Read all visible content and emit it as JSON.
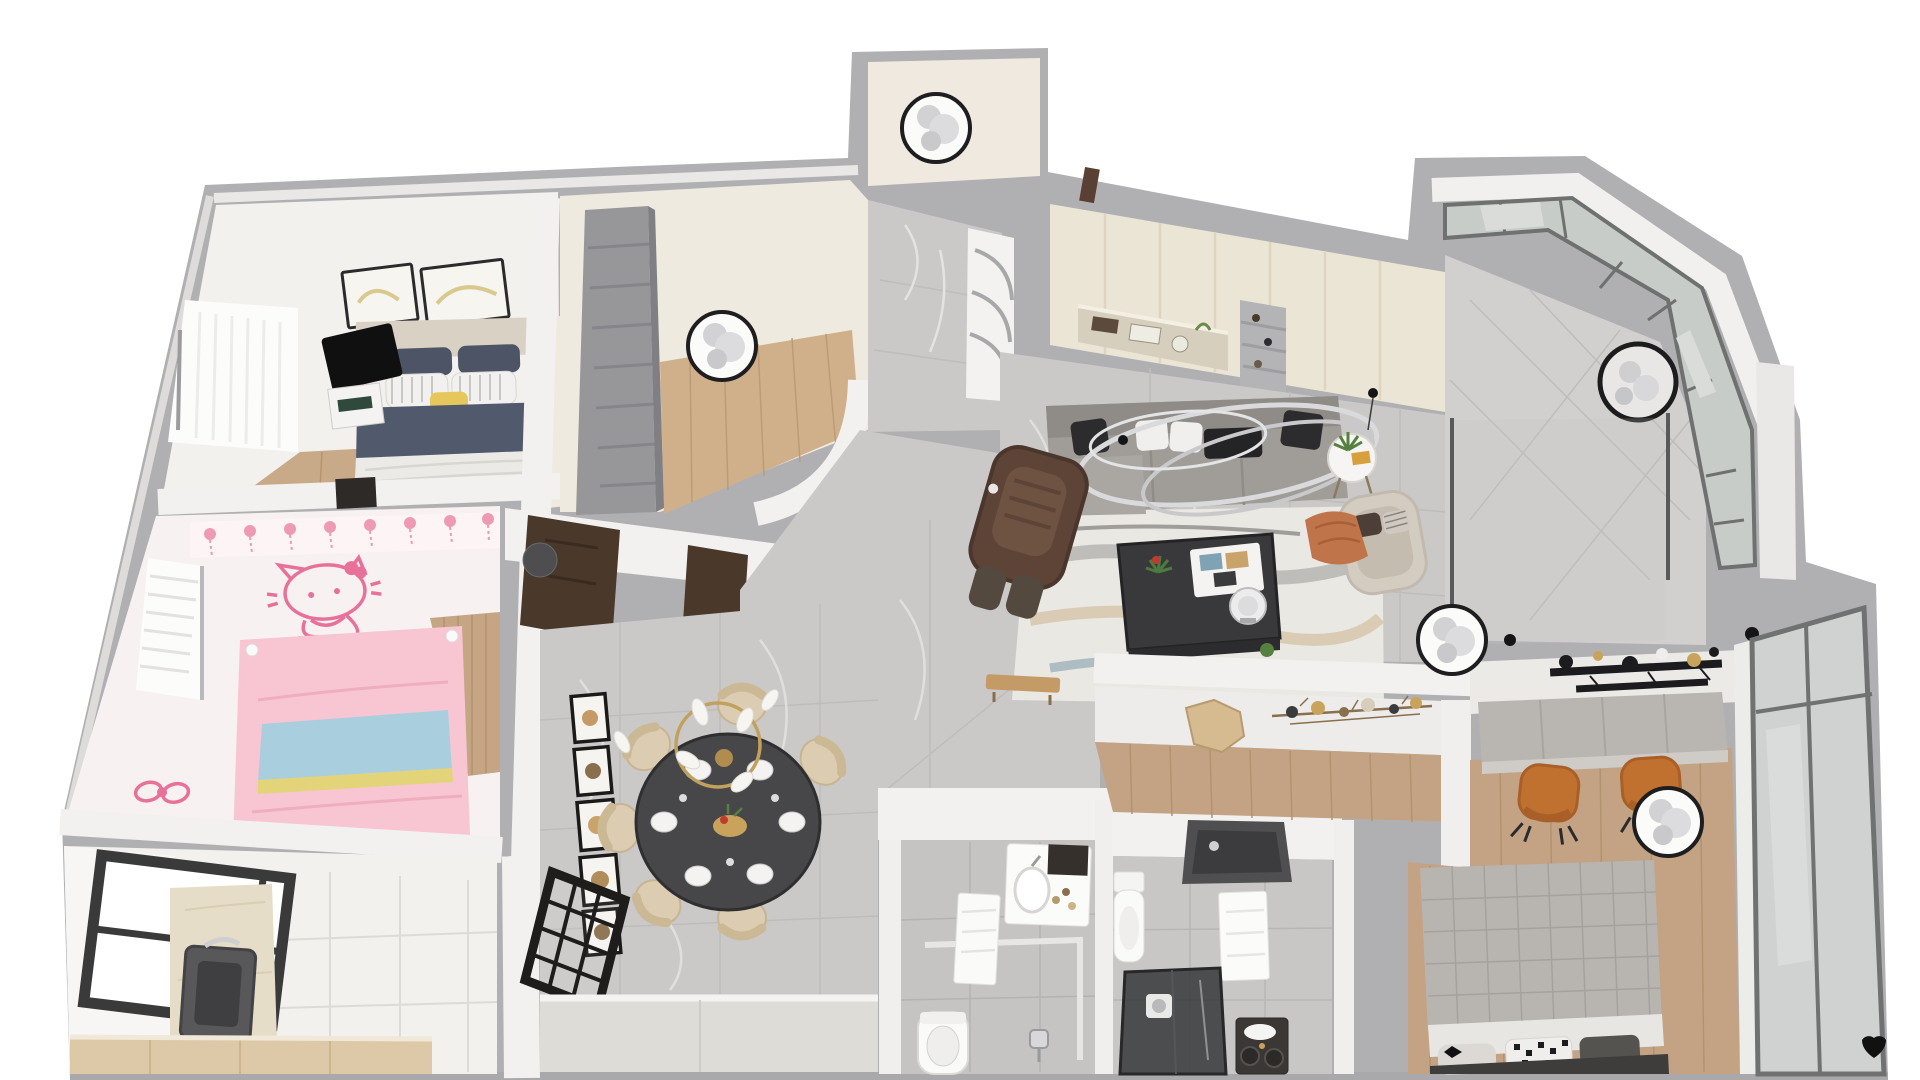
{
  "scene": {
    "title": "3D rendered apartment floor plan, top-down dollhouse view, no visible text",
    "background": "#ffffff"
  },
  "palette": {
    "outer_wall_gray": "#b0b0b3",
    "inner_wall_white": "#f2f1ef",
    "marble_floor": "#cbc9c8",
    "wood_floor": "#c3a384",
    "cream_cabinet": "#ebe5d5",
    "kitchen_counter": "#e6ddc8",
    "sofa_gray": "#a09c98",
    "navy_bedding": "#515a6c",
    "pink_theme": "#f2a9bd",
    "magenta_decor": "#c23a9e",
    "dining_table_dark": "#474749",
    "chair_tan": "#dccdb2",
    "gold_accent": "#c9a35c",
    "cognac_chair": "#c0702f",
    "black_accent": "#1c1c1e",
    "glass_gray": "#cdd0ce"
  },
  "rooms": {
    "master_bedroom": {
      "label": "Master bedroom",
      "furniture": [
        "double bed with beige headboard",
        "navy and white striped pillows",
        "yellow accent pillow",
        "navy duvet with white throw",
        "two framed artworks",
        "black TV panel",
        "nightstand",
        "sheer curtained window",
        "wardrobe"
      ]
    },
    "kids_bedroom": {
      "label": "Kids bedroom with Hello Kitty theme",
      "furniture": [
        "pink bed with blue and yellow banding",
        "Hello Kitty wall decal",
        "pink garland wallpaper border",
        "magenta crescent moon decor",
        "ribbon bow decal",
        "wood plank headboard wall",
        "window with blinds"
      ]
    },
    "kitchen": {
      "label": "Kitchen",
      "furniture": [
        "dark framed window",
        "beige stone counter with inset sink",
        "chrome faucet",
        "light wood base cabinets",
        "white tile floor"
      ]
    },
    "walk_in_closet": {
      "label": "Walk-in closet",
      "furniture": [
        "gray shelving unit",
        "round ceiling lamp",
        "wood floor",
        "curved partition wall"
      ]
    },
    "entry_hall": {
      "label": "Entry hall",
      "furniture": [
        "round ceiling fan",
        "curved display shelf",
        "dark round stool",
        "double dark wood doors",
        "marble floor"
      ]
    },
    "living_room": {
      "label": "Living room",
      "furniture": [
        "gray fabric sofa with black and white pillows",
        "sculptural silver ring chandelier",
        "brown massage chair",
        "black coffee table with books and plant",
        "white robot vacuum",
        "abstract area rug",
        "round side table with plant",
        "beige accent chair with orange throw",
        "cream built-in cabinet wall with display niches",
        "round ceiling fan"
      ]
    },
    "dining_room": {
      "label": "Dining room",
      "furniture": [
        "round dark dining table with six place settings",
        "six tan upholstered chairs",
        "gold ring pendant light with white leaves",
        "column of five gallery frames",
        "black framed glass partition",
        "light gray sideboard"
      ]
    },
    "balcony": {
      "label": "Balcony",
      "furniture": [
        "angled bay window band",
        "round ceiling fan",
        "marble floor with diagonal grout",
        "glass slider to living room"
      ]
    },
    "bathroom_a": {
      "label": "Bathroom",
      "furniture": [
        "white vanity with basin",
        "dark mirror cabinet",
        "toilet",
        "wall towel",
        "shower mixer",
        "gray tile floor with border"
      ]
    },
    "bathroom_b": {
      "label": "Second bathroom",
      "furniture": [
        "dark recessed shower ceiling panel",
        "toilet",
        "towel panel",
        "dark glass shower enclosure with washer",
        "vanity with rolled towels and twin basins"
      ]
    },
    "bedroom_two": {
      "label": "Second bedroom with study corner",
      "furniture": [
        "gray desk counter",
        "two cognac desk chairs",
        "black and gold stick wall art",
        "round ceiling fan",
        "gray quilted bed",
        "houndstooth and heart pillows",
        "hexagon wood wall decor",
        "metal branch wall art",
        "floor-to-ceiling window",
        "black heart decal"
      ]
    },
    "hallway": {
      "label": "Hallway",
      "furniture": [
        "wood bench",
        "marble floor"
      ]
    }
  },
  "ceiling_fixtures": [
    "entry hall fan",
    "walk-in closet lamp",
    "balcony fan",
    "living room edge fan",
    "bedroom fan",
    "dining gold ring pendant"
  ]
}
